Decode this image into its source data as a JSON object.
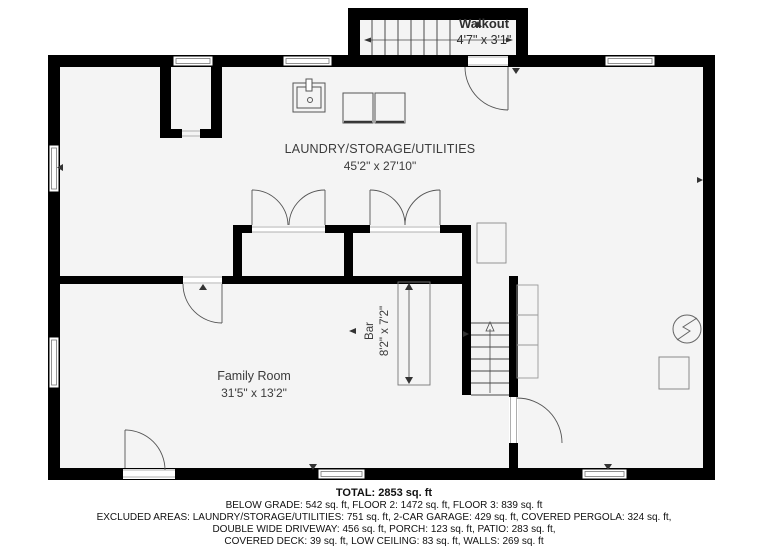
{
  "colors": {
    "wall": "#000000",
    "floor": "#f4f4f4",
    "symbol_line": "#4a4a4a",
    "light_outline": "#8a8a8a",
    "label_text": "#3b3b3b",
    "footer_text": "#111111"
  },
  "rooms": {
    "walkout": {
      "name": "Walkout",
      "dims": "4'7\" x 3'1\""
    },
    "laundry": {
      "name": "LAUNDRY/STORAGE/UTILITIES",
      "dims": "45'2\" x 27'10\""
    },
    "bar": {
      "name": "Bar",
      "dims": "8'2\" x 7'2\""
    },
    "family_room": {
      "name": "Family Room",
      "dims": "31'5\" x 13'2\""
    }
  },
  "summary": {
    "total": "TOTAL: 2853 sq. ft",
    "lines": [
      "BELOW GRADE: 542 sq. ft, FLOOR 2: 1472 sq. ft, FLOOR 3: 839 sq. ft",
      "EXCLUDED AREAS: LAUNDRY/STORAGE/UTILITIES: 751 sq. ft, 2-CAR GARAGE: 429 sq. ft, COVERED PERGOLA: 324 sq. ft,",
      "DOUBLE WIDE DRIVEWAY: 456 sq. ft, PORCH: 123 sq. ft, PATIO: 283 sq. ft,",
      "COVERED DECK: 39 sq. ft, LOW CEILING: 83 sq. ft, WALLS: 269 sq. ft"
    ]
  }
}
